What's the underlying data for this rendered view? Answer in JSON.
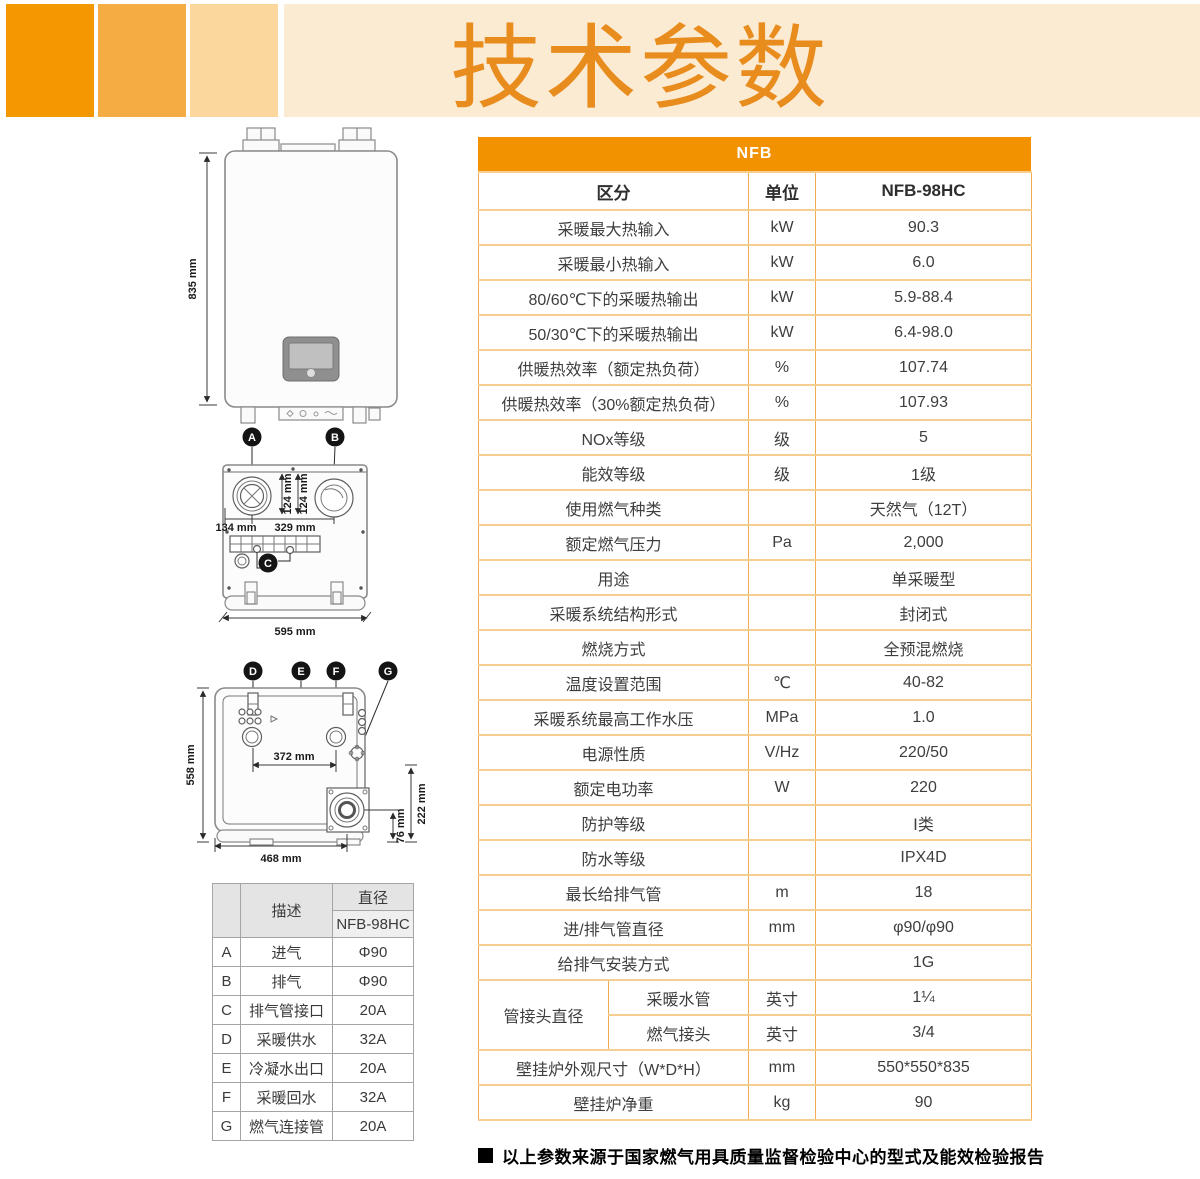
{
  "page": {
    "title": "技术参数"
  },
  "colors": {
    "banner_block_dark": "#F39800",
    "banner_block_mid": "#F5AD43",
    "banner_block_light": "#FBD79E",
    "banner_strip": "#FCEBD3",
    "title_orange": "#E98C1E",
    "table_band_orange": "#F29200",
    "table_border_h": "#F7CE92",
    "table_border_v": "#F2AC52",
    "text_dark": "#3E3E3E"
  },
  "main_table": {
    "band_title": "NFB",
    "headers": {
      "category": "区分",
      "unit": "单位",
      "model": "NFB-98HC"
    },
    "rows": [
      {
        "label": "采暖最大热输入",
        "unit": "kW",
        "value": "90.3"
      },
      {
        "label": "采暖最小热输入",
        "unit": "kW",
        "value": "6.0"
      },
      {
        "label": "80/60℃下的采暖热输出",
        "unit": "kW",
        "value": "5.9-88.4"
      },
      {
        "label": "50/30℃下的采暖热输出",
        "unit": "kW",
        "value": "6.4-98.0"
      },
      {
        "label": "供暖热效率（额定热负荷）",
        "unit": "%",
        "value": "107.74"
      },
      {
        "label": "供暖热效率（30%额定热负荷）",
        "unit": "%",
        "value": "107.93"
      },
      {
        "label": "NOx等级",
        "unit": "级",
        "value": "5"
      },
      {
        "label": "能效等级",
        "unit": "级",
        "value": "1级"
      },
      {
        "label": "使用燃气种类",
        "unit": "",
        "value": "天然气（12T）"
      },
      {
        "label": "额定燃气压力",
        "unit": "Pa",
        "value": "2,000"
      },
      {
        "label": "用途",
        "unit": "",
        "value": "单采暖型"
      },
      {
        "label": "采暖系统结构形式",
        "unit": "",
        "value": "封闭式"
      },
      {
        "label": "燃烧方式",
        "unit": "",
        "value": "全预混燃烧"
      },
      {
        "label": "温度设置范围",
        "unit": "℃",
        "value": "40-82"
      },
      {
        "label": "采暖系统最高工作水压",
        "unit": "MPa",
        "value": "1.0"
      },
      {
        "label": "电源性质",
        "unit": "V/Hz",
        "value": "220/50"
      },
      {
        "label": "额定电功率",
        "unit": "W",
        "value": "220"
      },
      {
        "label": "防护等级",
        "unit": "",
        "value": "Ⅰ类"
      },
      {
        "label": "防水等级",
        "unit": "",
        "value": "IPX4D"
      },
      {
        "label": "最长给排气管",
        "unit": "m",
        "value": "18"
      },
      {
        "label": "进/排气管直径",
        "unit": "mm",
        "value": "φ90/φ90"
      },
      {
        "label": "给排气安装方式",
        "unit": "",
        "value": "1G"
      },
      {
        "group": "管接头直径",
        "group_rowspan": 2,
        "label": "采暖水管",
        "unit": "英寸",
        "value": "1¼"
      },
      {
        "in_group": true,
        "label": "燃气接头",
        "unit": "英寸",
        "value": "3/4"
      },
      {
        "label": "壁挂炉外观尺寸（W*D*H）",
        "unit": "mm",
        "value": "550*550*835"
      },
      {
        "label": "壁挂炉净重",
        "unit": "kg",
        "value": "90"
      }
    ]
  },
  "connection_table": {
    "header_desc": "描述",
    "header_diameter": "直径",
    "header_model": "NFB-98HC",
    "rows": [
      {
        "key": "A",
        "desc": "进气",
        "value": "Φ90"
      },
      {
        "key": "B",
        "desc": "排气",
        "value": "Φ90"
      },
      {
        "key": "C",
        "desc": "排气管接口",
        "value": "20A"
      },
      {
        "key": "D",
        "desc": "采暖供水",
        "value": "32A"
      },
      {
        "key": "E",
        "desc": "冷凝水出口",
        "value": "20A"
      },
      {
        "key": "F",
        "desc": "采暖回水",
        "value": "32A"
      },
      {
        "key": "G",
        "desc": "燃气连接管",
        "value": "20A"
      }
    ]
  },
  "diagrams": {
    "front_view": {
      "height_label": "835 mm",
      "marker_a": "A",
      "marker_b": "B"
    },
    "top_view": {
      "dim_v1": "124 mm",
      "dim_v2": "124 mm",
      "dim_left": "134 mm",
      "dim_center": "329 mm",
      "dim_width": "595 mm",
      "marker_c": "C"
    },
    "bottom_view": {
      "marker_d": "D",
      "marker_e": "E",
      "marker_f": "F",
      "marker_g": "G",
      "dim_height": "558 mm",
      "dim_center": "372 mm",
      "dim_width": "468 mm",
      "dim_small": "76 mm",
      "dim_right": "222 mm"
    }
  },
  "footer": {
    "note": "以上参数来源于国家燃气用具质量监督检验中心的型式及能效检验报告"
  }
}
